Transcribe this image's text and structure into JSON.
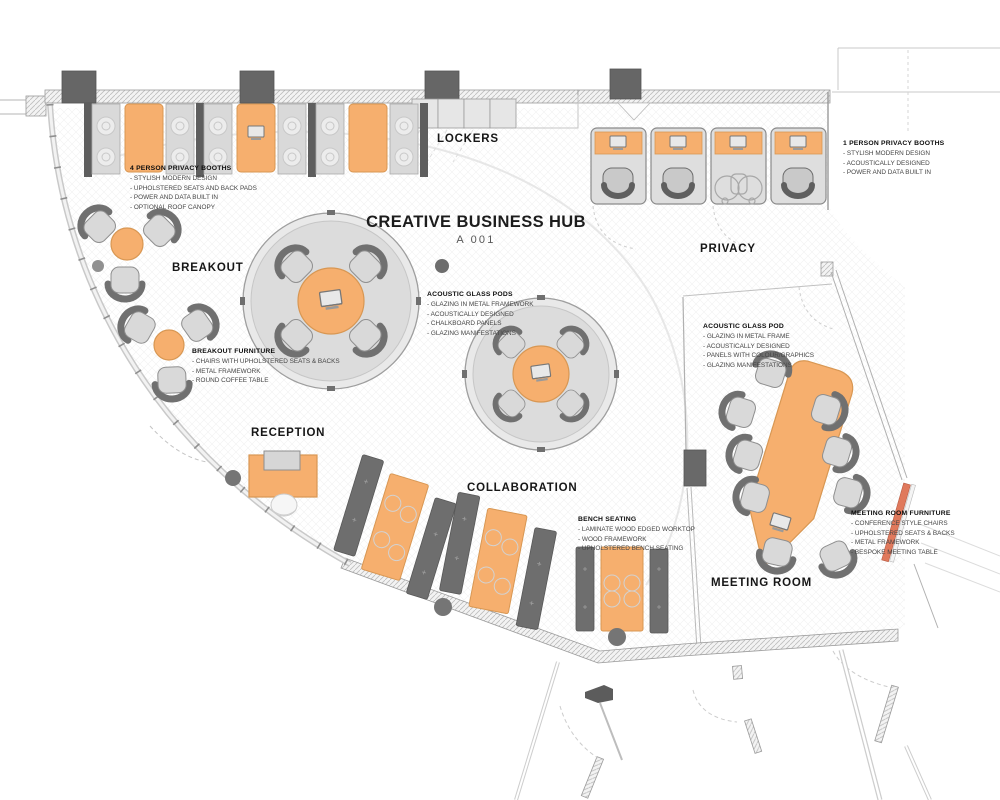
{
  "title": {
    "main": "CREATIVE BUSINESS HUB",
    "code": "A 001"
  },
  "room_labels": {
    "lockers": "LOCKERS",
    "privacy": "PRIVACY",
    "breakout": "BREAKOUT",
    "reception": "RECEPTION",
    "collaboration": "COLLABORATION",
    "meeting_room": "MEETING ROOM"
  },
  "annotations": {
    "privacy_booths_4": {
      "heading": "4 PERSON PRIVACY BOOTHS",
      "items": [
        "STYLISH MODERN DESIGN",
        "UPHOLSTERED SEATS AND BACK PADS",
        "POWER AND DATA BUILT IN",
        "OPTIONAL ROOF CANOPY"
      ]
    },
    "privacy_booths_1": {
      "heading": "1 PERSON PRIVACY BOOTHS",
      "items": [
        "STYLISH MODERN DESIGN",
        "ACOUSTICALLY DESIGNED",
        "POWER AND DATA BUILT IN"
      ]
    },
    "acoustic_glass_pods": {
      "heading": "ACOUSTIC GLASS PODS",
      "items": [
        "GLAZING IN METAL FRAMEWORK",
        "ACOUSTICALLY DESIGNED",
        "CHALKBOARD PANELS",
        "GLAZING MANIFESTATIONS"
      ]
    },
    "acoustic_glass_pod": {
      "heading": "ACOUSTIC GLASS POD",
      "items": [
        "GLAZING IN METAL FRAME",
        "ACOUSTICALLY DESIGNED",
        "PANELS WITH COLOUR/GRAPHICS",
        "GLAZING MANIFESTATIONS"
      ]
    },
    "breakout_furniture": {
      "heading": "BREAKOUT FURNITURE",
      "items": [
        "CHAIRS WITH UPHOLSTERED SEATS & BACKS",
        "METAL FRAMEWORK",
        "ROUND COFFEE TABLE"
      ]
    },
    "bench_seating": {
      "heading": "BENCH SEATING",
      "items": [
        "LAMINATE WOOD EDGED WORKTOP",
        "WOOD FRAMEWORK",
        "UPHOLSTERED BENCH SEATING"
      ]
    },
    "meeting_room_furniture": {
      "heading": "MEETING ROOM FURNITURE",
      "items": [
        "CONFERENCE STYLE CHAIRS",
        "UPHOLSTERED SEATS & BACKS",
        "METAL FRAMEWORK",
        "BESPOKE MEETING TABLE"
      ]
    }
  },
  "icons": {
    "laptop": "laptop-icon",
    "wheelchair": "wheelchair-icon"
  },
  "colors": {
    "furniture_orange": "#F6AF6E",
    "furniture_orange_border": "#D89753",
    "bench_dark_gray": "#6E6E6E",
    "seat_light_gray": "#D9D9D9",
    "accent_salmon": "#E0795C",
    "wall_gray": "#9B9B9B"
  }
}
